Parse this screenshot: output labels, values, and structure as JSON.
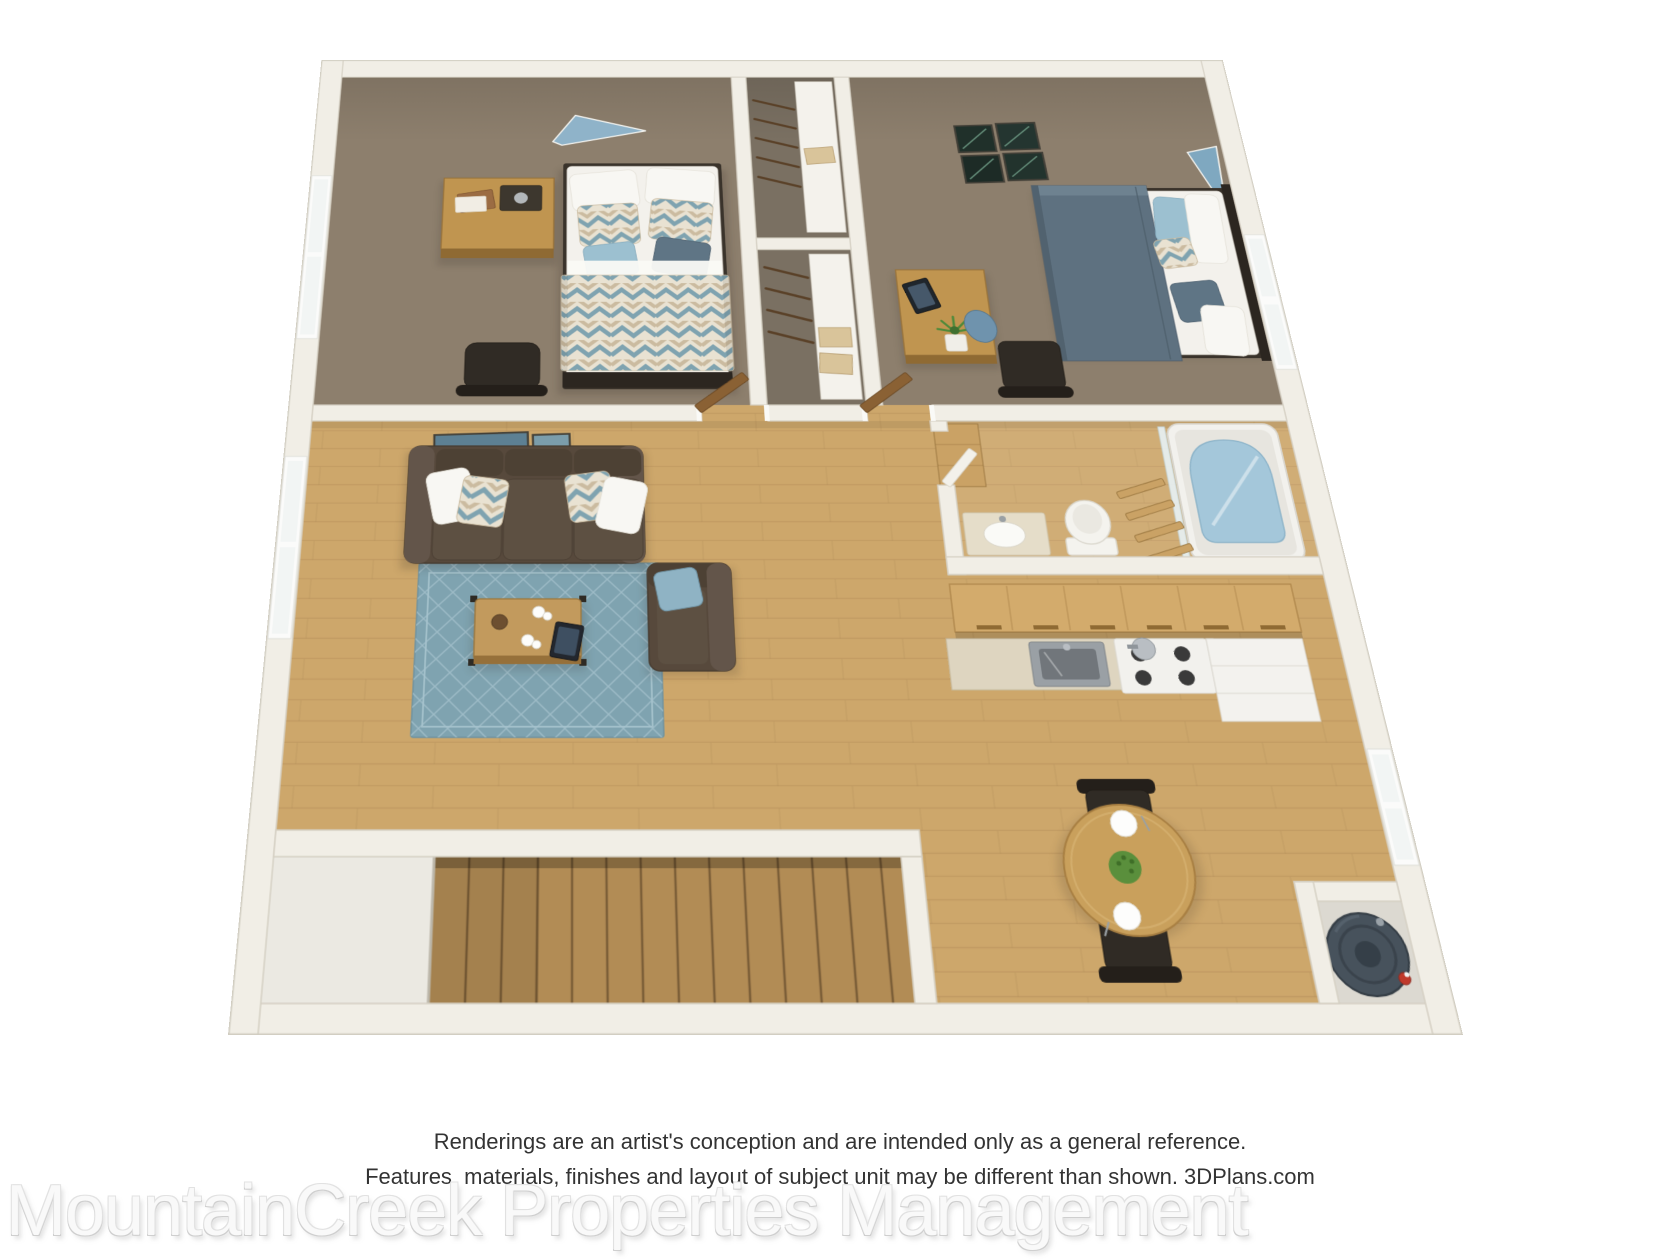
{
  "disclaimer": {
    "line1": "Renderings are an artist's conception and are intended only as a general reference.",
    "line2": "Features, materials, finishes and layout of subject unit may be different than shown. 3DPlans.com"
  },
  "watermark": {
    "text": "MountainCreek Properties Management"
  },
  "palette": {
    "wall": "#f1eee6",
    "wall_edge": "#d5d0c3",
    "carpet": "#8d7f6d",
    "wood": "#cda76b",
    "stairs": "#b28c55",
    "rug": "#7fa3b0",
    "rug_line": "#a6c3cd",
    "sofa": "#57493c",
    "accent_blue": "#8fb3c4",
    "bed_blanket": "#5e7180",
    "cabinet_wood": "#d3ab6c",
    "counter": "#ded5c0",
    "water": "#a4c7da",
    "heater": "#47525c"
  }
}
